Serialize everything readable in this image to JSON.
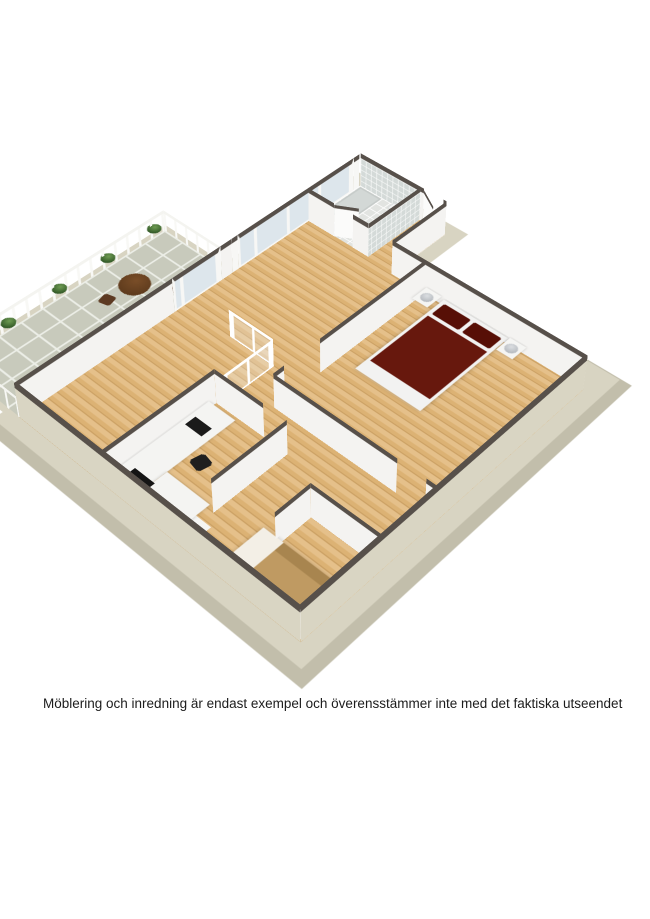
{
  "caption": {
    "text": "Möblering och inredning är endast exempel och överensstämmer inte med det faktiska utseendet"
  },
  "colors": {
    "bg": "#ffffff",
    "captionText": "#1c1c1c",
    "slabTop": "#d8d4c2",
    "slabSide": "#c2beab",
    "wallTop": "#57504a",
    "wallFace": "#f4f3f1",
    "exteriorFace": "#d9d5c3",
    "woodLight": "#e5c08a",
    "woodMid": "#dcb274",
    "woodSeam": "#c89d60",
    "balconyTile": "#c8cabc",
    "tileGrout": "#eceee7",
    "bathTileWall": "#d4dad8",
    "bathFloor": "#e2e4e1",
    "bedSpread": "#67180d",
    "pillow": "#570f06",
    "bedFrame": "#f2f2f1",
    "sofaTan": "#bf9a62",
    "furnitureWood": "#5d3a1c",
    "chairWood": "#5d3a22",
    "plantDark": "#2f5524",
    "lamp": "#b7bbc0",
    "black": "#1a1a1a",
    "glass": "#dde6ec"
  }
}
